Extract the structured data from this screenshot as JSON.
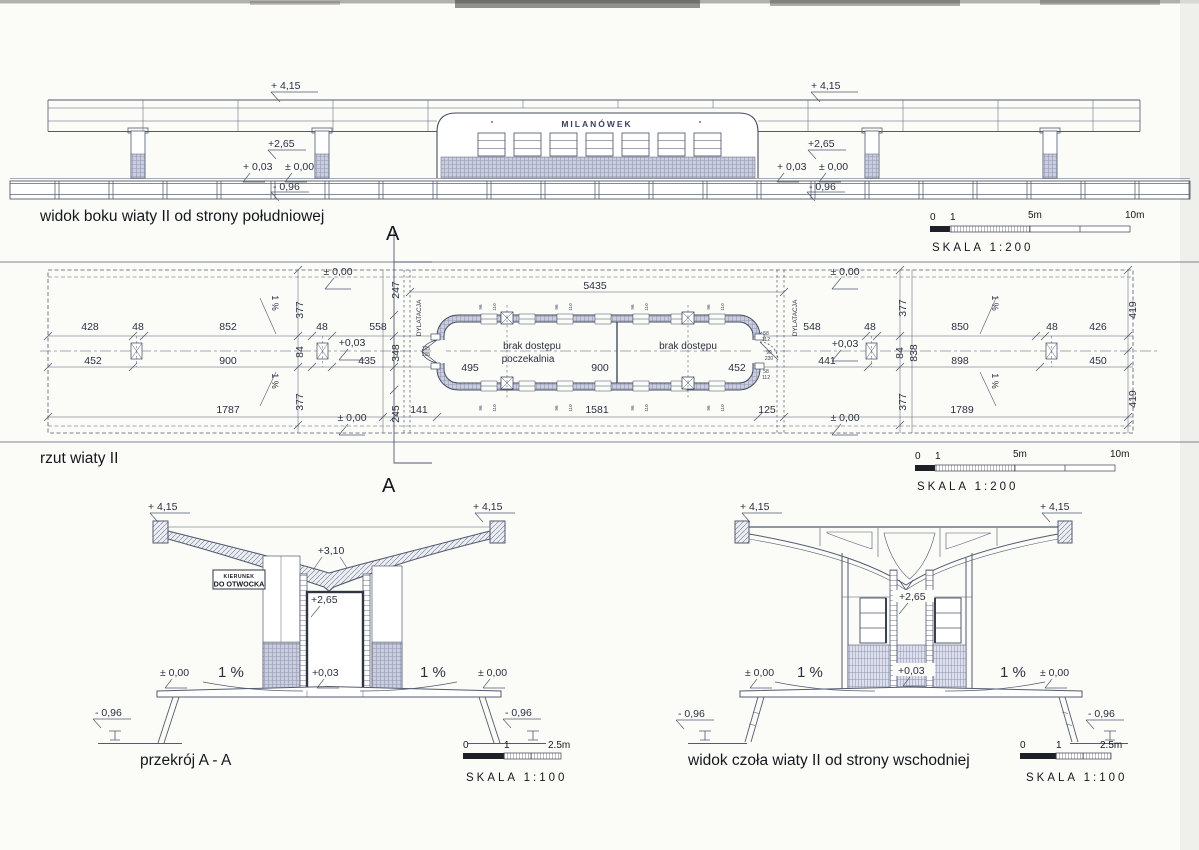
{
  "side_view": {
    "title": "widok boku wiaty II od strony południowej",
    "station_sign": "MILANÓWEK",
    "levels": [
      {
        "t": "+ 4,15",
        "x": 271,
        "y": 89
      },
      {
        "t": "+ 4,15",
        "x": 811,
        "y": 89
      },
      {
        "t": "+2,65",
        "x": 268,
        "y": 147
      },
      {
        "t": "+2,65",
        "x": 808,
        "y": 147
      },
      {
        "t": "+ 0,03",
        "x": 243,
        "y": 170
      },
      {
        "t": "± 0,00",
        "x": 285,
        "y": 170
      },
      {
        "t": "+ 0,03",
        "x": 777,
        "y": 170
      },
      {
        "t": "± 0,00",
        "x": 819,
        "y": 170
      },
      {
        "t": "- 0,96",
        "x": 273,
        "y": 190
      },
      {
        "t": "- 0,96",
        "x": 809,
        "y": 190
      }
    ]
  },
  "plan": {
    "title": "rzut wiaty II",
    "no_access": "brak dostępu",
    "waiting_room": "poczekalnia",
    "dims": [
      {
        "t": "428",
        "x": 90,
        "y": 330
      },
      {
        "t": "48",
        "x": 138,
        "y": 330
      },
      {
        "t": "852",
        "x": 228,
        "y": 330
      },
      {
        "t": "48",
        "x": 322,
        "y": 330
      },
      {
        "t": "558",
        "x": 378,
        "y": 330
      },
      {
        "t": "548",
        "x": 812,
        "y": 330
      },
      {
        "t": "48",
        "x": 870,
        "y": 330
      },
      {
        "t": "850",
        "x": 960,
        "y": 330
      },
      {
        "t": "48",
        "x": 1052,
        "y": 330
      },
      {
        "t": "426",
        "x": 1098,
        "y": 330
      },
      {
        "t": "452",
        "x": 93,
        "y": 364
      },
      {
        "t": "900",
        "x": 228,
        "y": 364
      },
      {
        "t": "435",
        "x": 367,
        "y": 364
      },
      {
        "t": "441",
        "x": 827,
        "y": 364
      },
      {
        "t": "898",
        "x": 960,
        "y": 364
      },
      {
        "t": "450",
        "x": 1098,
        "y": 364
      },
      {
        "t": "1787",
        "x": 228,
        "y": 413
      },
      {
        "t": "141",
        "x": 419,
        "y": 413
      },
      {
        "t": "1581",
        "x": 597,
        "y": 413
      },
      {
        "t": "125",
        "x": 767,
        "y": 413
      },
      {
        "t": "1789",
        "x": 962,
        "y": 413
      },
      {
        "t": "495",
        "x": 470,
        "y": 371
      },
      {
        "t": "900",
        "x": 600,
        "y": 371
      },
      {
        "t": "452",
        "x": 737,
        "y": 371
      },
      {
        "t": "5435",
        "x": 595,
        "y": 289
      },
      {
        "t": "377",
        "x": 303,
        "y": 310,
        "r": -90
      },
      {
        "t": "84",
        "x": 303,
        "y": 352,
        "r": -90
      },
      {
        "t": "377",
        "x": 303,
        "y": 402,
        "r": -90
      },
      {
        "t": "247",
        "x": 399,
        "y": 290,
        "r": -90
      },
      {
        "t": "348",
        "x": 399,
        "y": 353,
        "r": -90
      },
      {
        "t": "245",
        "x": 399,
        "y": 414,
        "r": -90
      },
      {
        "t": "377",
        "x": 906,
        "y": 308,
        "r": -90
      },
      {
        "t": "84",
        "x": 903,
        "y": 353,
        "r": -90
      },
      {
        "t": "838",
        "x": 917,
        "y": 353,
        "r": -90
      },
      {
        "t": "377",
        "x": 906,
        "y": 402,
        "r": -90
      },
      {
        "t": "419",
        "x": 1136,
        "y": 310,
        "r": -90
      },
      {
        "t": "419",
        "x": 1136,
        "y": 399,
        "r": -90
      },
      {
        "t": "± 0,00",
        "x": 338,
        "y": 275
      },
      {
        "t": "+0,03",
        "x": 352,
        "y": 346
      },
      {
        "t": "± 0,00",
        "x": 352,
        "y": 421
      },
      {
        "t": "± 0,00",
        "x": 845,
        "y": 275
      },
      {
        "t": "+0,03",
        "x": 845,
        "y": 347
      },
      {
        "t": "± 0,00",
        "x": 845,
        "y": 421
      },
      {
        "t": "1 %",
        "x": 272,
        "y": 303,
        "r": 90,
        "s": 9
      },
      {
        "t": "1 %",
        "x": 272,
        "y": 381,
        "r": 90,
        "s": 9
      },
      {
        "t": "1 %",
        "x": 992,
        "y": 303,
        "r": 90,
        "s": 9
      },
      {
        "t": "1 %",
        "x": 992,
        "y": 381,
        "r": 90,
        "s": 9
      },
      {
        "t": "DYLATACJA",
        "x": 421,
        "y": 318,
        "r": -90,
        "s": 6.5
      },
      {
        "t": "DYLATACJA",
        "x": 797,
        "y": 318,
        "r": -90,
        "s": 6.5
      }
    ],
    "small": [
      {
        "t": "96",
        "x": 482,
        "y": 307,
        "r": -90
      },
      {
        "t": "110",
        "x": 496,
        "y": 307,
        "r": -90
      },
      {
        "t": "96",
        "x": 558,
        "y": 307,
        "r": -90
      },
      {
        "t": "110",
        "x": 572,
        "y": 307,
        "r": -90
      },
      {
        "t": "96",
        "x": 634,
        "y": 307,
        "r": -90
      },
      {
        "t": "110",
        "x": 648,
        "y": 307,
        "r": -90
      },
      {
        "t": "96",
        "x": 710,
        "y": 307,
        "r": -90
      },
      {
        "t": "110",
        "x": 724,
        "y": 307,
        "r": -90
      },
      {
        "t": "96",
        "x": 482,
        "y": 408,
        "r": -90
      },
      {
        "t": "110",
        "x": 496,
        "y": 408,
        "r": -90
      },
      {
        "t": "96",
        "x": 558,
        "y": 408,
        "r": -90
      },
      {
        "t": "110",
        "x": 572,
        "y": 408,
        "r": -90
      },
      {
        "t": "96",
        "x": 634,
        "y": 408,
        "r": -90
      },
      {
        "t": "110",
        "x": 648,
        "y": 408,
        "r": -90
      },
      {
        "t": "96",
        "x": 710,
        "y": 408,
        "r": -90
      },
      {
        "t": "110",
        "x": 724,
        "y": 408,
        "r": -90
      },
      {
        "t": "58",
        "x": 766,
        "y": 335,
        "s": 5
      },
      {
        "t": "112",
        "x": 766,
        "y": 341,
        "s": 5
      },
      {
        "t": "90",
        "x": 769,
        "y": 354,
        "s": 5
      },
      {
        "t": "230",
        "x": 769,
        "y": 360,
        "s": 5
      },
      {
        "t": "58",
        "x": 766,
        "y": 373,
        "s": 5
      },
      {
        "t": "112",
        "x": 766,
        "y": 379,
        "s": 5
      },
      {
        "t": "105",
        "x": 426,
        "y": 350,
        "s": 5
      },
      {
        "t": "205",
        "x": 426,
        "y": 356,
        "s": 5
      }
    ]
  },
  "section": {
    "title": "przekrój A - A",
    "sign_line1": "KIERUNEK",
    "sign_line2": "DO OTWOCKA",
    "labels": [
      {
        "t": "+ 4,15",
        "x": 148,
        "y": 510
      },
      {
        "t": "+ 4,15",
        "x": 473,
        "y": 510
      },
      {
        "t": "+3,10",
        "x": 331,
        "y": 554,
        "a": "middle"
      },
      {
        "t": "+2,65",
        "x": 311,
        "y": 603
      },
      {
        "t": "± 0,00",
        "x": 160,
        "y": 676
      },
      {
        "t": "1 %",
        "x": 218,
        "y": 677,
        "s": 15
      },
      {
        "t": "+0,03",
        "x": 312,
        "y": 676
      },
      {
        "t": "1 %",
        "x": 420,
        "y": 677,
        "s": 15
      },
      {
        "t": "± 0,00",
        "x": 478,
        "y": 676
      },
      {
        "t": "- 0,96",
        "x": 95,
        "y": 716
      },
      {
        "t": "- 0,96",
        "x": 505,
        "y": 716
      }
    ]
  },
  "east_view": {
    "title": "widok czoła wiaty II od strony wschodniej",
    "labels": [
      {
        "t": "+ 4,15",
        "x": 740,
        "y": 510
      },
      {
        "t": "+ 4,15",
        "x": 1040,
        "y": 510
      },
      {
        "t": "+2,65",
        "x": 899,
        "y": 600
      },
      {
        "t": "± 0,00",
        "x": 745,
        "y": 676
      },
      {
        "t": "1 %",
        "x": 797,
        "y": 677,
        "s": 15
      },
      {
        "t": "+0,03",
        "x": 898,
        "y": 674
      },
      {
        "t": "1 %",
        "x": 1000,
        "y": 677,
        "s": 15
      },
      {
        "t": "± 0,00",
        "x": 1040,
        "y": 676
      },
      {
        "t": "- 0,96",
        "x": 678,
        "y": 717
      },
      {
        "t": "- 0,96",
        "x": 1088,
        "y": 717
      }
    ]
  },
  "section_marker": "A",
  "scale_bars": [
    {
      "scale_label": "SKALA 1:200",
      "ticks": [
        {
          "t": "0",
          "x": 930,
          "y": 220
        },
        {
          "t": "1",
          "x": 950,
          "y": 220
        },
        {
          "t": "5m",
          "x": 1028,
          "y": 218
        },
        {
          "t": "10m",
          "x": 1125,
          "y": 218
        }
      ]
    },
    {
      "scale_label": "SKALA 1:200",
      "ticks": [
        {
          "t": "0",
          "x": 915,
          "y": 459
        },
        {
          "t": "1",
          "x": 935,
          "y": 459
        },
        {
          "t": "5m",
          "x": 1013,
          "y": 457
        },
        {
          "t": "10m",
          "x": 1110,
          "y": 457
        }
      ]
    },
    {
      "scale_label": "SKALA 1:100",
      "ticks": [
        {
          "t": "0",
          "x": 463,
          "y": 748
        },
        {
          "t": "1",
          "x": 504,
          "y": 748
        },
        {
          "t": "2.5m",
          "x": 548,
          "y": 748
        }
      ]
    },
    {
      "scale_label": "SKALA 1:100",
      "ticks": [
        {
          "t": "0",
          "x": 1020,
          "y": 748
        },
        {
          "t": "1",
          "x": 1056,
          "y": 748
        },
        {
          "t": "2.5m",
          "x": 1100,
          "y": 748
        }
      ]
    }
  ]
}
